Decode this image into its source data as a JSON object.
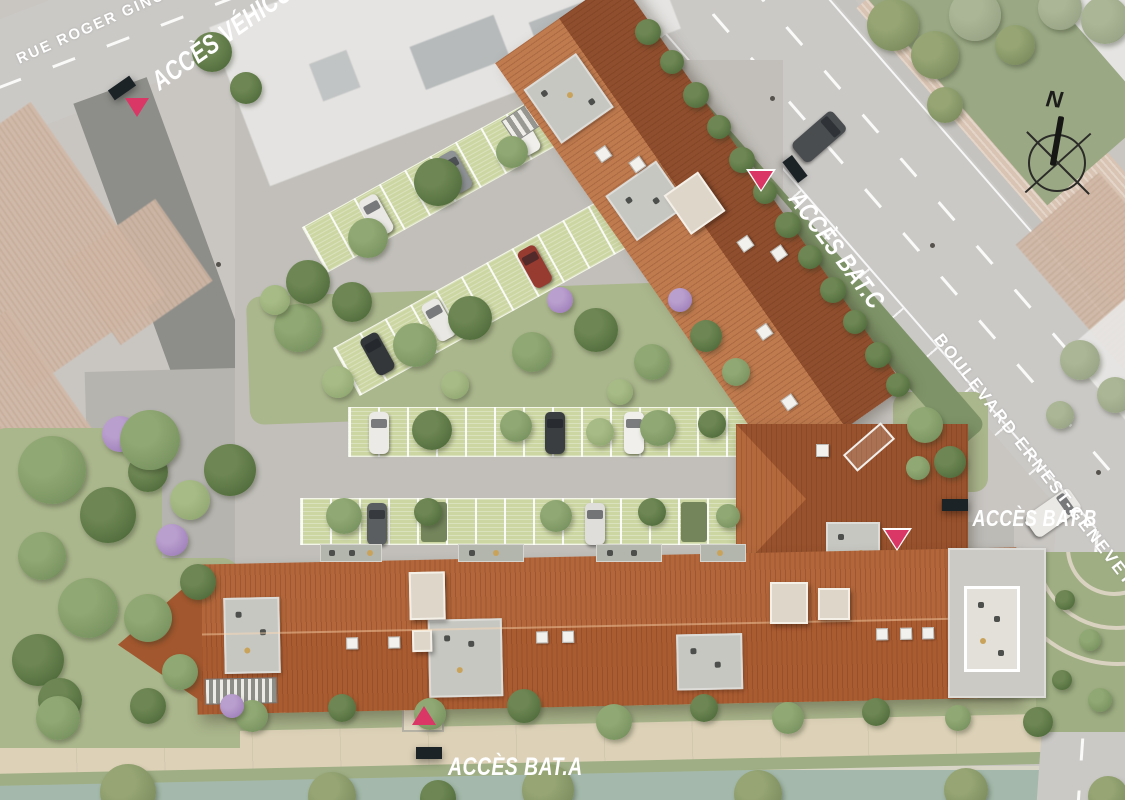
{
  "site": {
    "streets": {
      "rue": "RUE ROGER GINOUX",
      "boulevard": "BOULEVARD ERNEST-GENEVET"
    },
    "access": {
      "vehicles": "ACCÈS VÉHICULES",
      "bat_a": "ACCÈS BAT.A",
      "bat_b": "ACCÈS BAT.B",
      "bat_c": "ACCÈS BAT.C"
    },
    "compass": {
      "north": "N"
    },
    "colors": {
      "marker": "#da3766",
      "banner": "#1b2327",
      "roof_light": "#bf7a4e",
      "roof_dark": "#8f4e2d",
      "roof_a": "#b2663a",
      "parking": "#ccd6a3",
      "water": "#a4b9ab",
      "road": "#cbc9c6",
      "sidewalk": "#d9c3b2",
      "path": "#ddd2b8"
    }
  }
}
